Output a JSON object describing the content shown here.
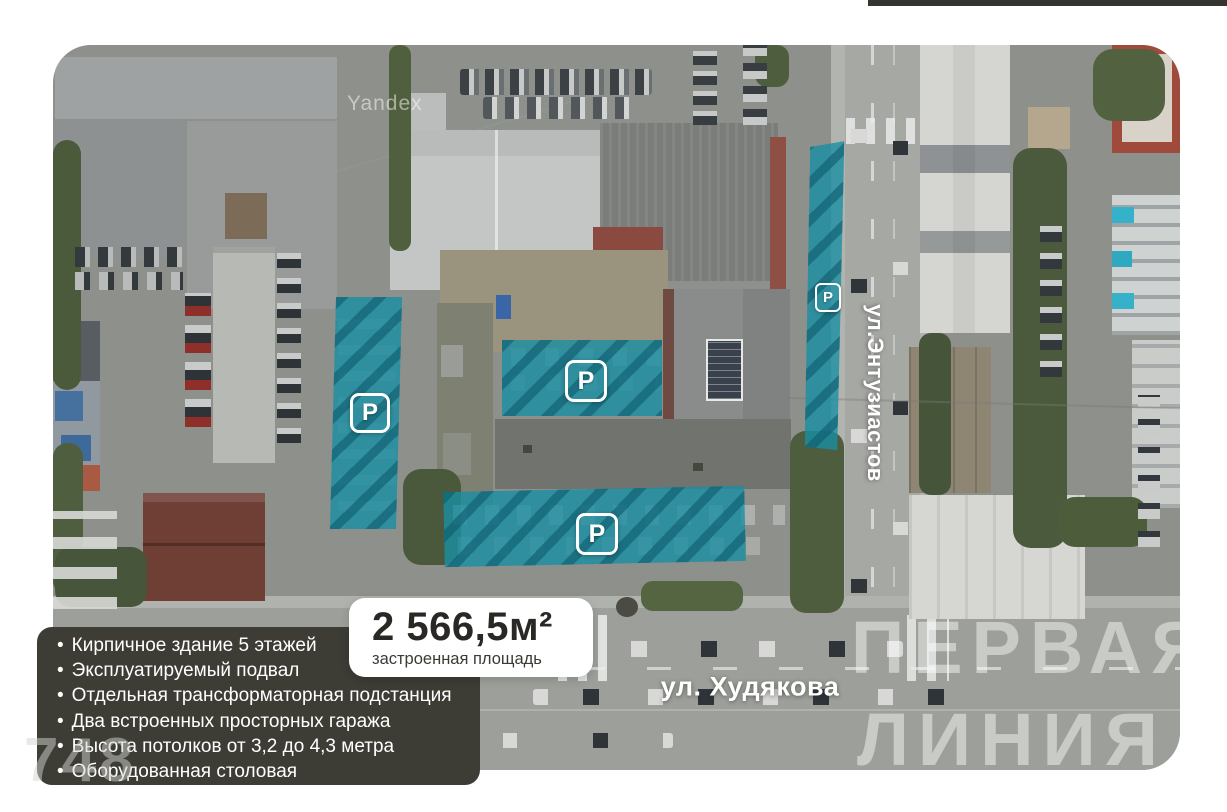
{
  "map": {
    "provider_watermark": "Yandex",
    "streets": {
      "vertical": "ул.Энтузиастов",
      "horizontal": "ул. Худякова"
    },
    "parking": {
      "symbol": "P"
    },
    "brand_watermark": {
      "line1": "ПЕРВАЯ",
      "line2": "ЛИНИЯ"
    },
    "watermark_number": "748"
  },
  "area_callout": {
    "value": "2 566,5м²",
    "label": "застроенная площадь"
  },
  "features": {
    "bullet": "•",
    "items": [
      "Кирпичное здание 5 этажей",
      "Эксплуатируемый подвал",
      "Отдельная трансформаторная подстанция",
      "Два встроенных просторных  гаража",
      "Высота потолков от 3,2 до 4,3 метра",
      "Оборудованная столовая"
    ]
  },
  "colors": {
    "parking_fill": "rgba(25,142,162,0.8)",
    "parking_stripe": "rgba(12,90,110,0.6)",
    "card_bg": "#3d3c35",
    "top_bar": "#35342f"
  }
}
